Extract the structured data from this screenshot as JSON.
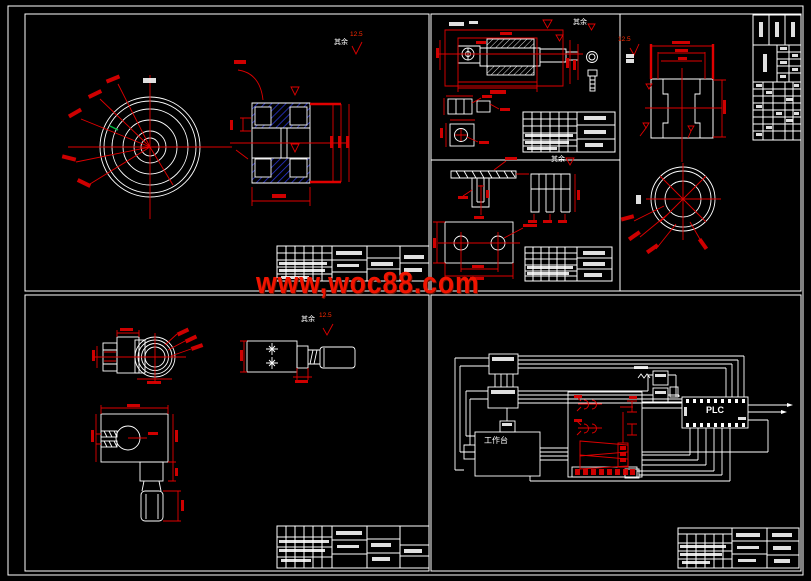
{
  "watermark": {
    "text": "www,woc88.com",
    "color": "#f01400"
  },
  "labels": {
    "plc": "PLC",
    "worktable": "工作台",
    "surface_note": "其余",
    "roughness_value": "12.5"
  },
  "colors": {
    "background": "#000000",
    "line_white": "#ffffff",
    "dimension_red": "#e00000",
    "hatch_blue": "#2233cc",
    "green_mark": "#00c040",
    "watermark_red": "#f01400"
  }
}
